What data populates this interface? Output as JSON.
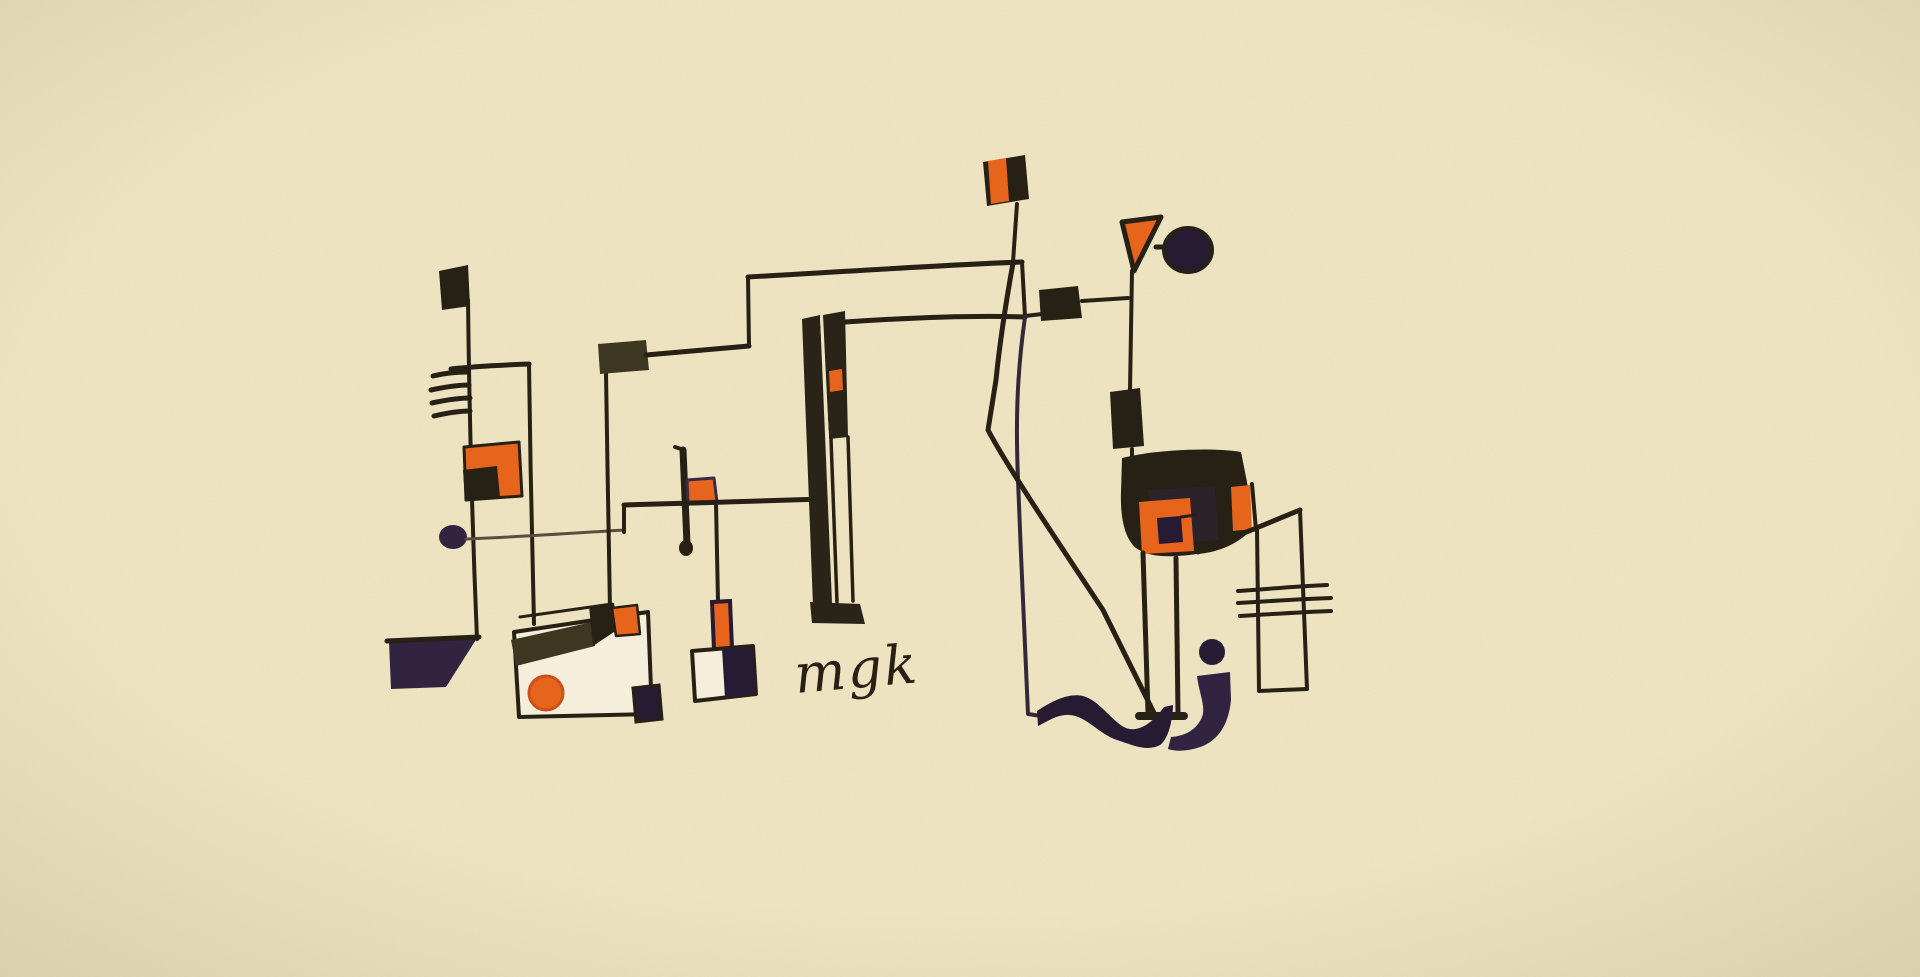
{
  "artwork": {
    "signature": "mgk"
  },
  "colors": {
    "paper": "#f0e5c3",
    "paper_deep": "#e3d7b1",
    "ink": "#272014",
    "ink_soft": "#5a4f3e",
    "bar": "#2a2317",
    "olive": "#3d3620",
    "orange": "#e7641d",
    "orange_deep": "#c9511a",
    "purple": "#322440",
    "purple_deep": "#271a33",
    "card": "#f5eedb"
  }
}
